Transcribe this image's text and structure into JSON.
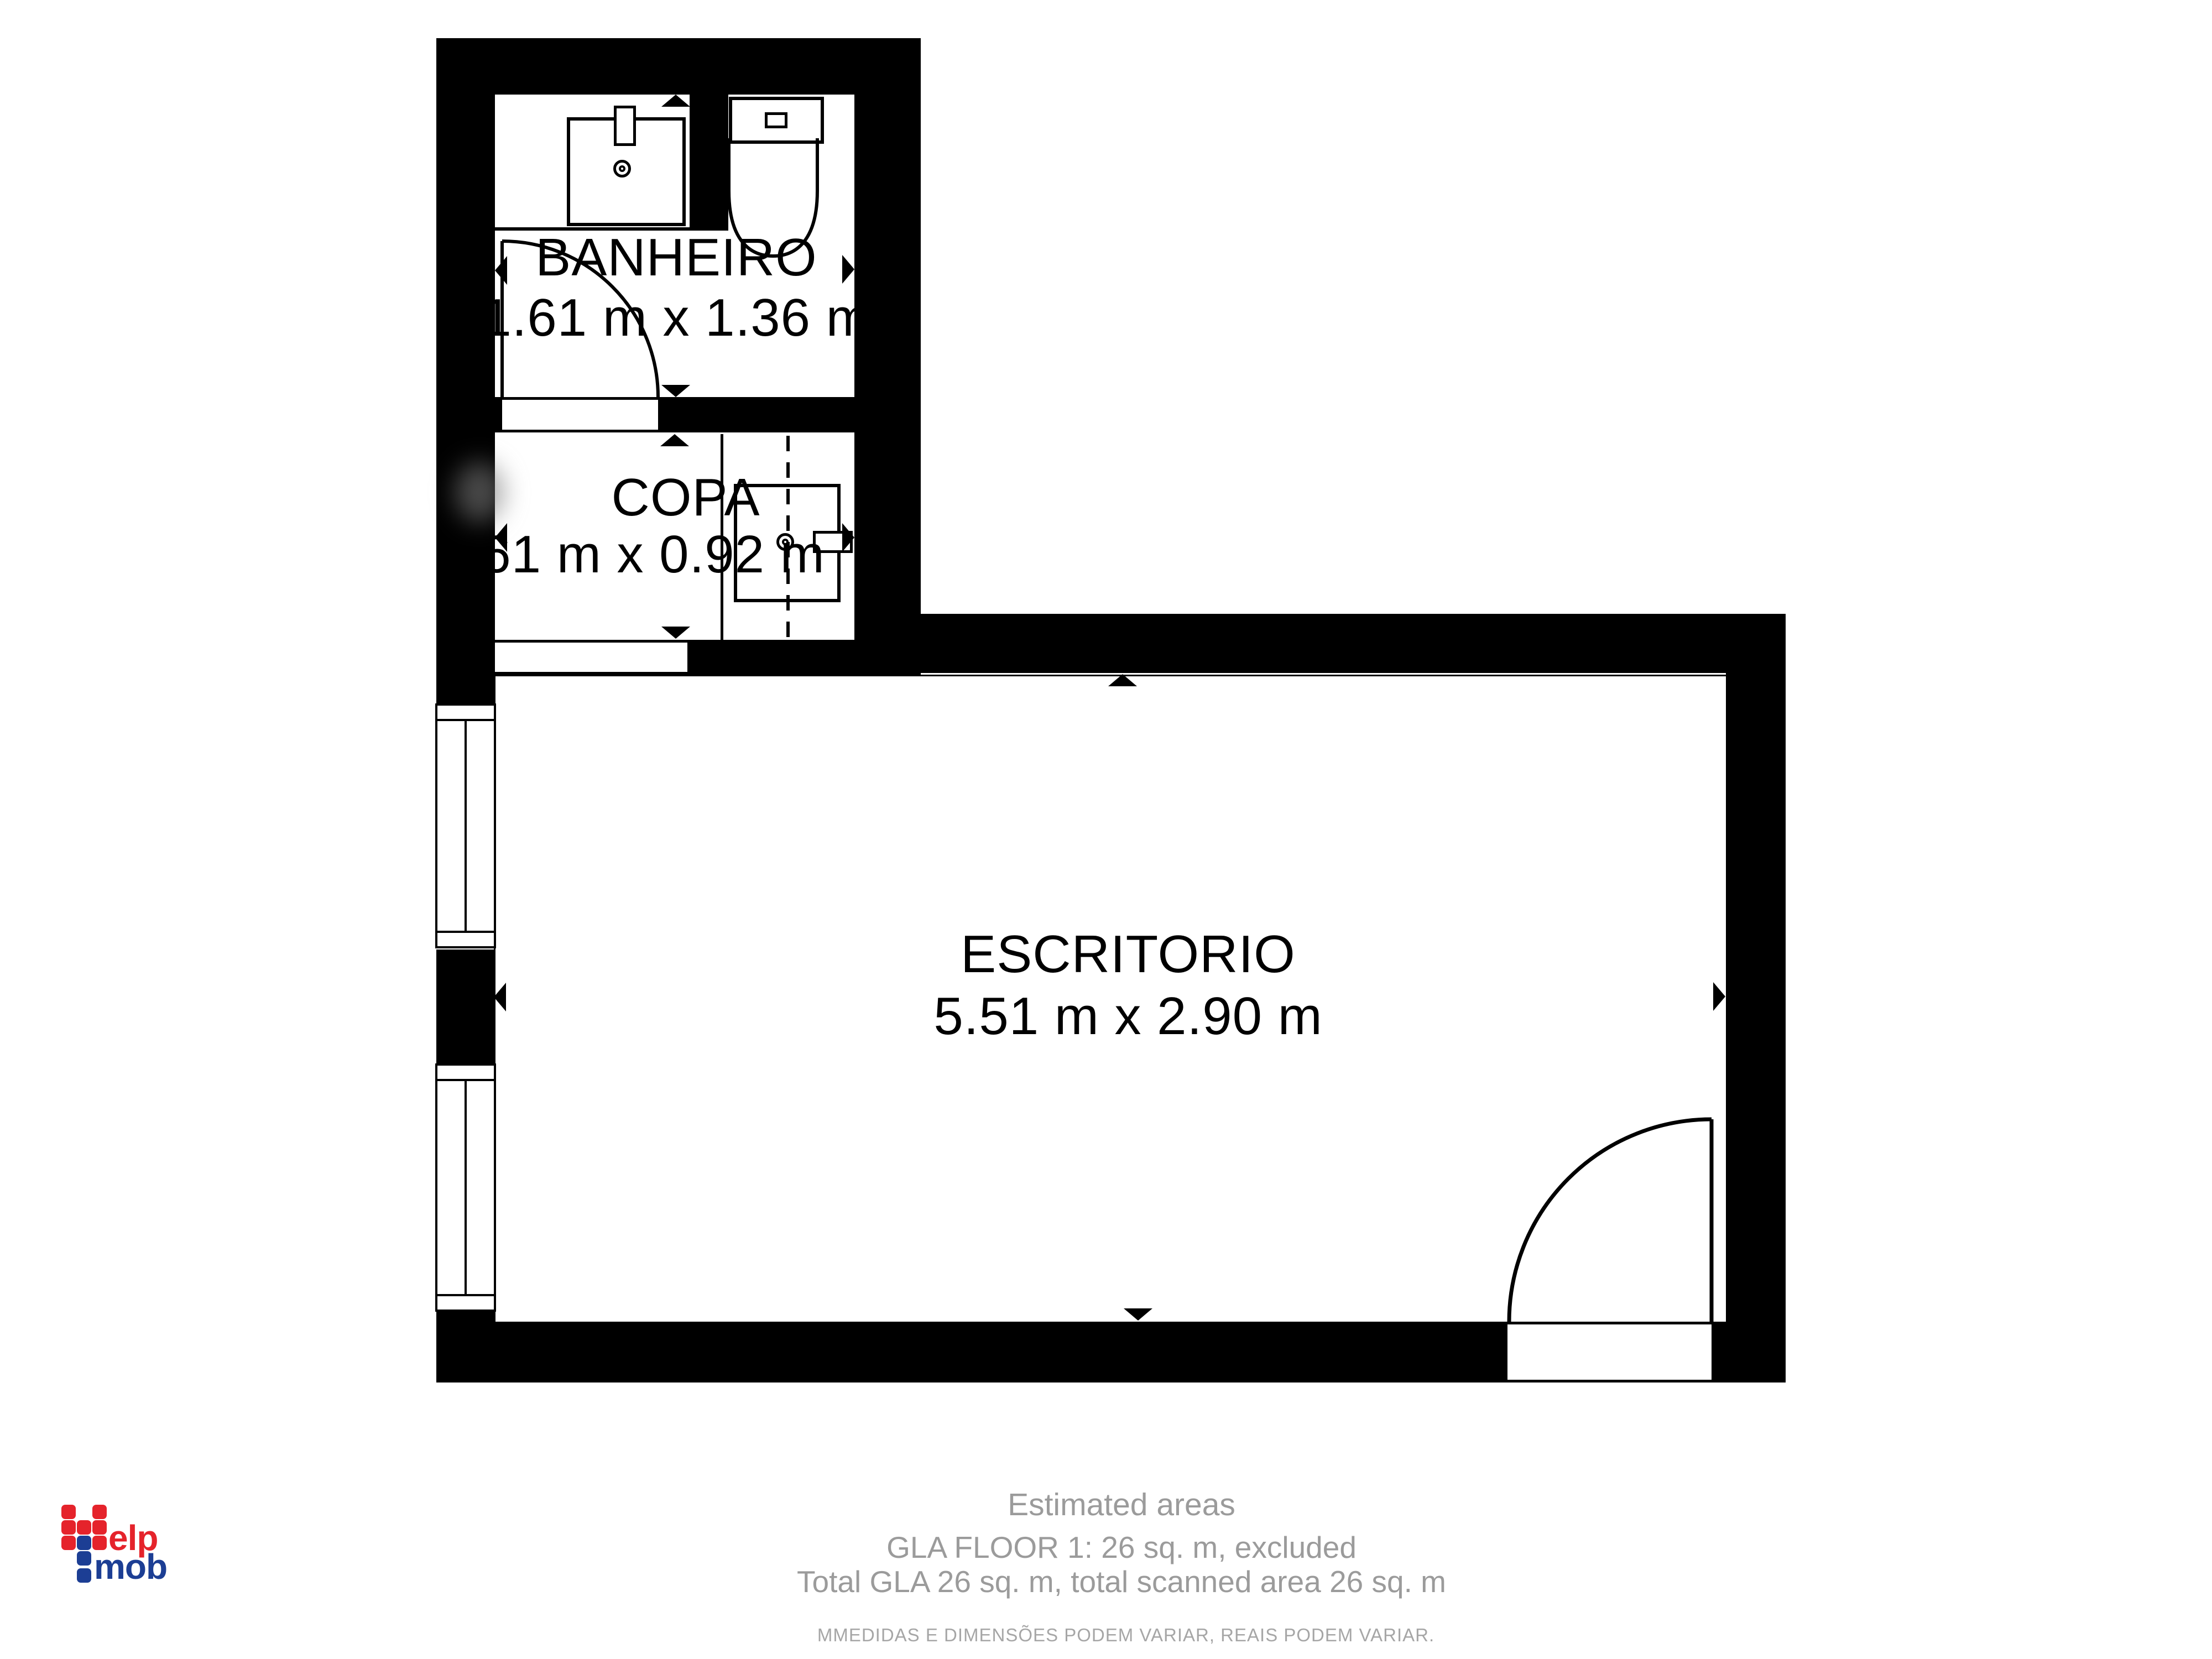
{
  "floorplan": {
    "rooms": [
      {
        "id": "banheiro",
        "name": "BANHEIRO",
        "dimensions": "1.61 m x 1.36 m"
      },
      {
        "id": "copa",
        "name": "COPA",
        "dimensions": "1.61 m x 0.92 m"
      },
      {
        "id": "escritorio",
        "name": "ESCRITORIO",
        "dimensions": "5.51 m x 2.90 m"
      }
    ]
  },
  "footer": {
    "title": "Estimated areas",
    "gla_line": "GLA FLOOR 1: 26 sq. m, excluded",
    "total_line": "Total GLA 26 sq. m, total scanned area 26 sq. m",
    "disclaimer": "MMEDIDAS E DIMENSÕES PODEM VARIAR, REAIS PODEM VARIAR."
  },
  "logo": {
    "word_top": "elp",
    "word_bottom": "mob",
    "color_red": "#e5232b",
    "color_blue": "#1c3e94"
  },
  "colors": {
    "wall": "#000000",
    "floor": "#ffffff",
    "footer_text": "#9b9b9b",
    "disclaimer_text": "#a6a6a6"
  }
}
